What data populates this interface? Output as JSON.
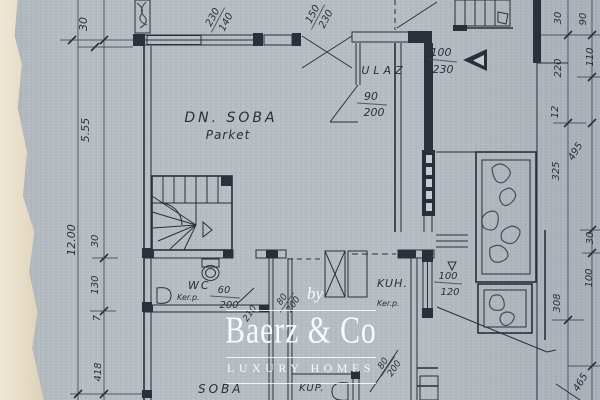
{
  "colors": {
    "paper": "#b6bdc3",
    "ink": "#2a3039",
    "paper_edge": "#e7ddc9",
    "watermark_text": "#ffffff"
  },
  "watermark": {
    "by": "by",
    "brand": "Baerz & Co",
    "tagline": "LUXURY HOMES"
  },
  "rooms": {
    "dn_soba": {
      "name": "DN. SOBA",
      "floor": "Parket"
    },
    "ulaz": {
      "name": "ULAZ"
    },
    "wc": {
      "name": "WC",
      "floor": "Ker.p."
    },
    "kuh": {
      "name": "KUH.",
      "floor": "Ker.p."
    },
    "soba": {
      "name": "SOBA"
    },
    "kup": {
      "name": "KUP."
    }
  },
  "openings": {
    "window_top_left": {
      "w": "230",
      "h": "140"
    },
    "window_top_right": {
      "w": "150",
      "h": "230"
    },
    "entry_door": {
      "w": "100",
      "h": "230"
    },
    "vestibule_door": {
      "w": "90",
      "h": "200"
    },
    "wc_door": {
      "w": "60",
      "h": "200"
    },
    "hall_door": {
      "w": "80",
      "h": "200"
    },
    "hall_width": {
      "w": "210"
    },
    "kup_door": {
      "w": "80",
      "h": "200"
    },
    "kitchen_window": {
      "w": "100",
      "h": "120"
    }
  },
  "dim_chains": {
    "left_outer": [
      "5.55",
      "12.00"
    ],
    "left_inner": [
      "30",
      "30",
      "130",
      "7",
      "418"
    ],
    "right_inner": [
      "30",
      "220",
      "12",
      "325",
      "308"
    ],
    "right_outer": [
      "90",
      "110",
      "495",
      "30",
      "100",
      "465"
    ]
  }
}
